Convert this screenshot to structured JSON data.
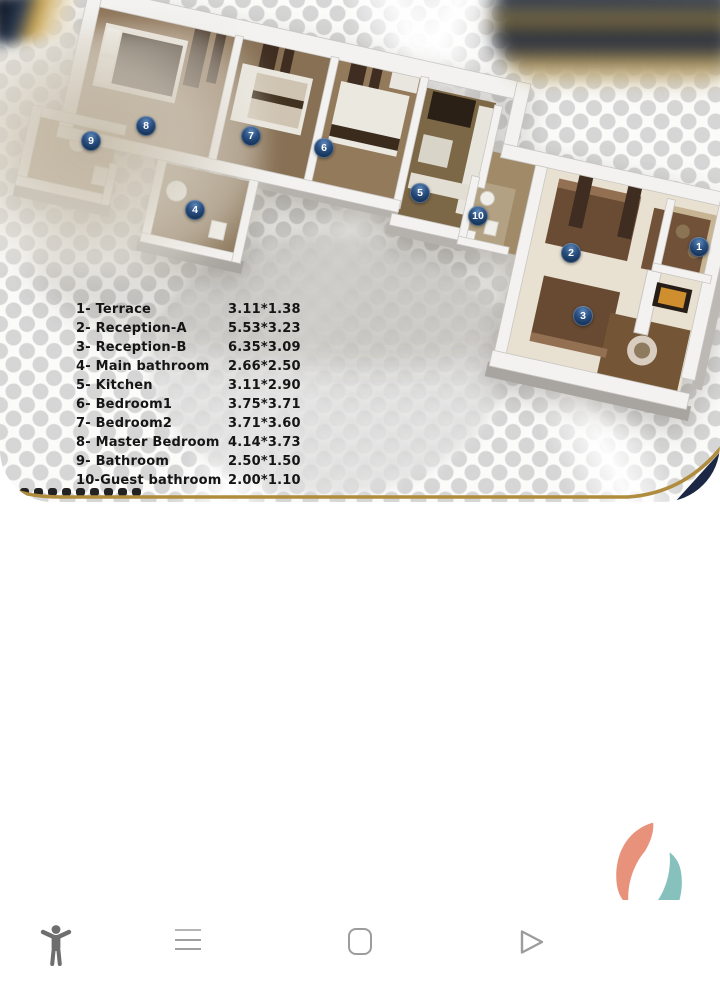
{
  "flyer": {
    "rooms": [
      {
        "num": "1",
        "label": "1- Terrace",
        "size": "3.11*1.38"
      },
      {
        "num": "2",
        "label": "2- Reception-A",
        "size": "5.53*3.23"
      },
      {
        "num": "3",
        "label": "3- Reception-B",
        "size": "6.35*3.09"
      },
      {
        "num": "4",
        "label": "4- Main bathroom",
        "size": "2.66*2.50"
      },
      {
        "num": "5",
        "label": "5- Kitchen",
        "size": "3.11*2.90"
      },
      {
        "num": "6",
        "label": "6- Bedroom1",
        "size": "3.75*3.71"
      },
      {
        "num": "7",
        "label": "7- Bedroom2",
        "size": "3.71*3.60"
      },
      {
        "num": "8",
        "label": "8- Master Bedroom",
        "size": "4.14*3.73"
      },
      {
        "num": "9",
        "label": "9- Bathroom",
        "size": "2.50*1.50"
      },
      {
        "num": "10",
        "label": "10-Guest bathroom",
        "size": "2.00*1.10"
      }
    ],
    "colors": {
      "border_gold": "#b08c3e",
      "corner_navy": "#1b2744",
      "marker_navy": "#163358"
    }
  },
  "logo": {
    "icon": "brand-logo-icon",
    "colors": {
      "orange": "#e8917b",
      "teal": "#86c1bd"
    }
  },
  "nav": {
    "icons": [
      {
        "name": "accessibility-icon"
      },
      {
        "name": "menu-icon"
      },
      {
        "name": "home-icon"
      },
      {
        "name": "back-icon"
      }
    ]
  }
}
